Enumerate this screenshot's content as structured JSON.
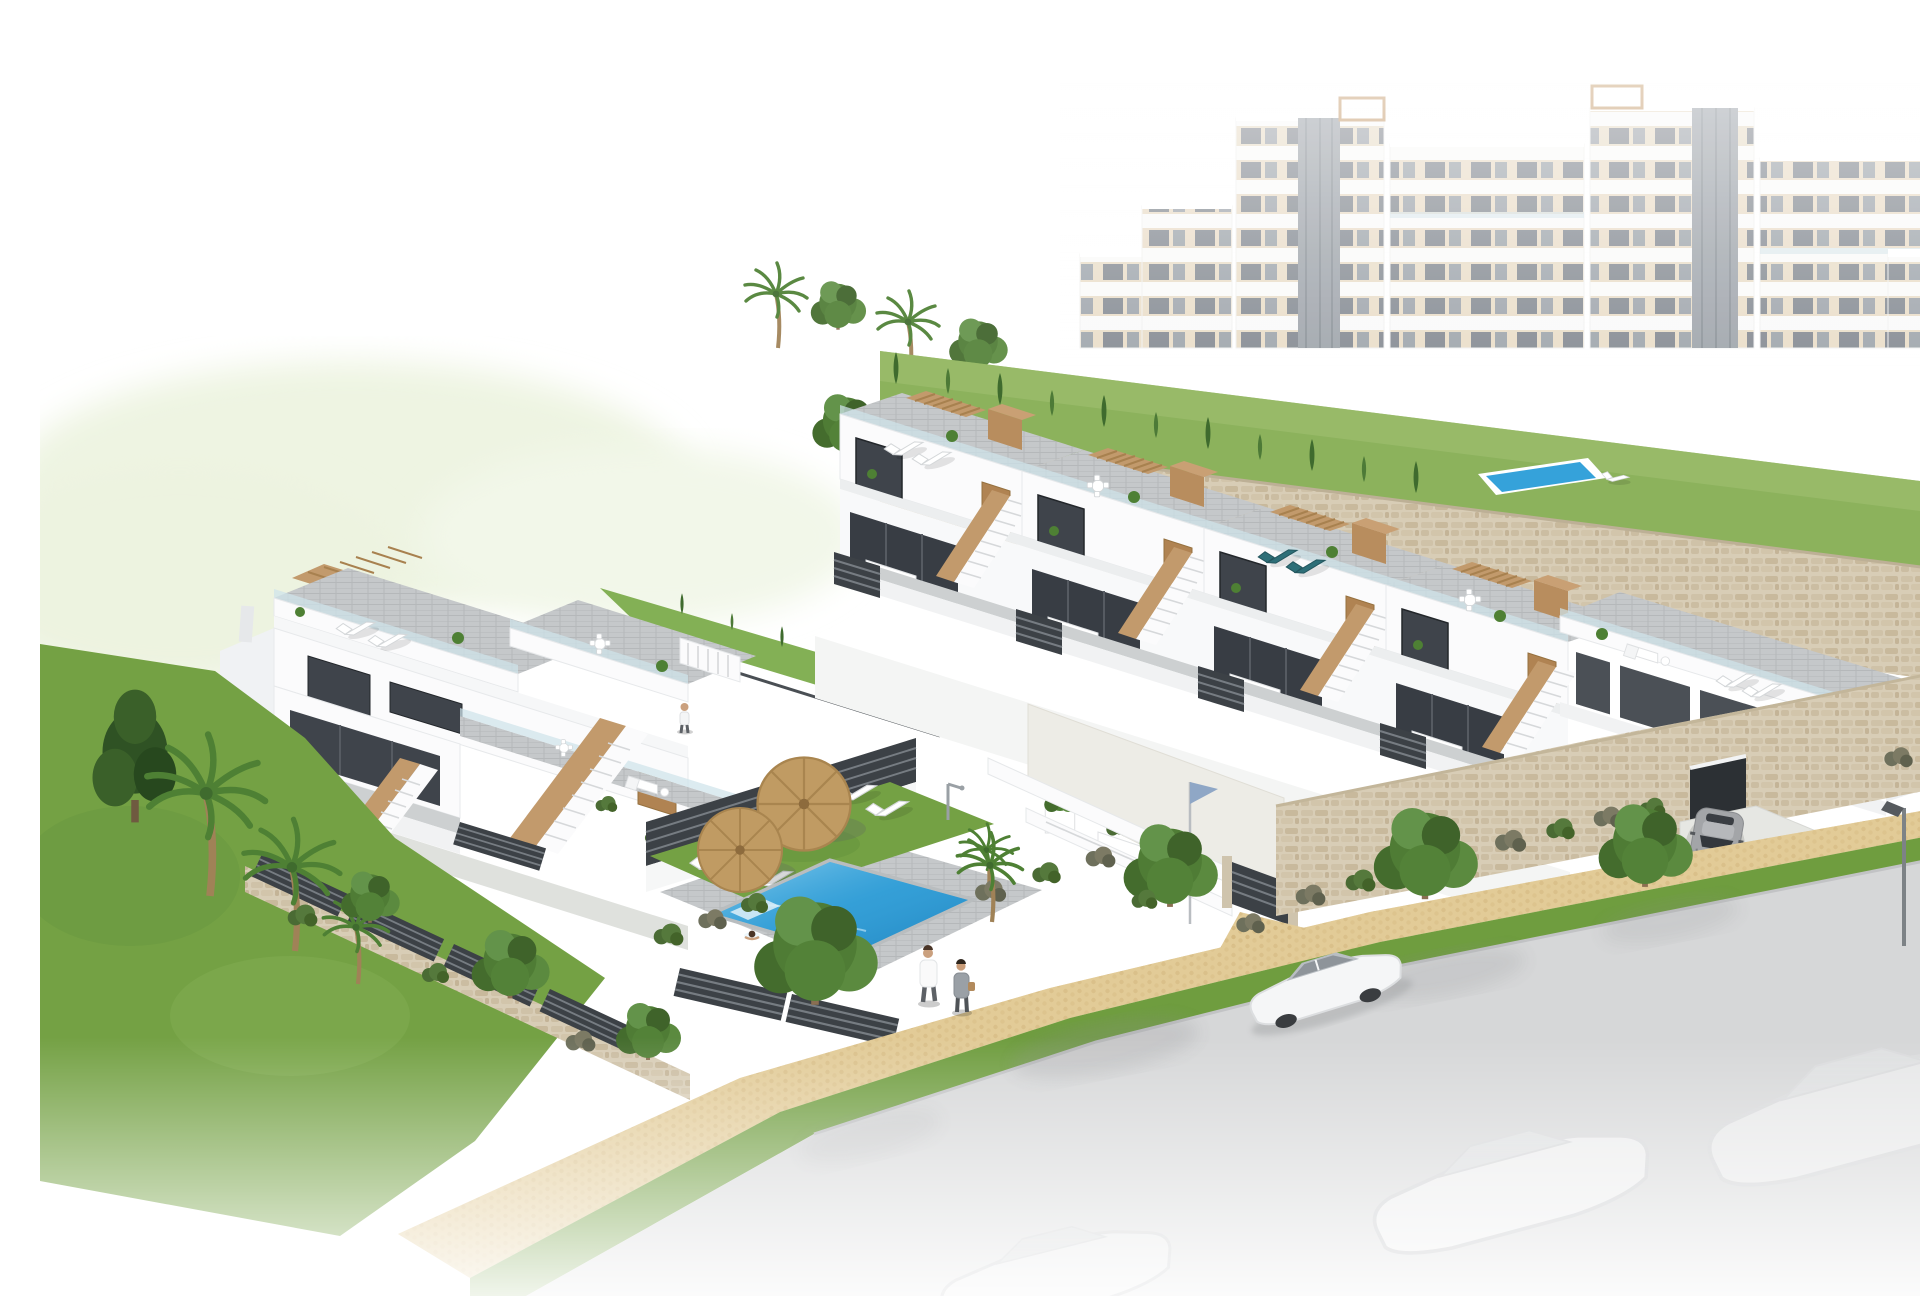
{
  "scene": {
    "title": "Aerial 3D render of a modern white residential complex with communal pool",
    "description": "Photorealistic architectural visualization: hazy white apartment towers with beige panels in the background on a stone-walled slope; two rows of white terraced townhouses with roof terraces, tan wood pergolas, external staircases and dark slatted fences; a communal pool area with two straw parasols, six white sun loungers, a sunbather and a swimmer; landscaped gardens with palms, cypresses and hedges; a beige cobble path with two pedestrians; a grey street fading to white with a white sedan, faint ghost cars, a grey coupe on a garage driveway, a small flag pole and a street lamp.",
    "style": "architectural-cgi",
    "background_color": "#ffffff",
    "palette": {
      "wall_white": "#fbfbfc",
      "wall_shadow": "#e8eaed",
      "wood_accent": "#c29a6c",
      "pergola_slat": "#a8814f",
      "glass_dark": "#3f444b",
      "glass_light": "#cfe3ea",
      "terrace_paver": "#c5c8ca",
      "stone_wall": "#d8cdb6",
      "plaster_wall": "#edece6",
      "grass": "#74a144",
      "hedge_dark": "#4a6b34",
      "tree_green": "#54823a",
      "pool_blue": "#2d9ad4",
      "umbrella_straw": "#c09b63",
      "cobble_path": "#e2cb97",
      "road_asphalt": "#d6d7d8",
      "fence_dark": "#3c4146",
      "flag_blue": "#8fa7c6"
    },
    "inventory": {
      "apartment_towers": 6,
      "townhouse_units_right_row": 4,
      "townhouse_end_house": 1,
      "townhouse_left_block_levels": 3,
      "pools": 2,
      "straw_parasols": 2,
      "pool_sun_loungers": 6,
      "roof_furniture_sets": 6,
      "people": 5,
      "cars_visible": 2,
      "ghost_cars": 3,
      "palm_trees": 6,
      "cypress_trees": 20,
      "big_trees": 7,
      "street_lamps": 1,
      "flag_poles": 1,
      "garage_doors": 2,
      "gates": 1
    },
    "people": [
      {
        "id": "terrace-walker",
        "desc": "person standing on first-floor terrace"
      },
      {
        "id": "sunbather",
        "desc": "woman in pink on a lounger by the pool"
      },
      {
        "id": "swimmer",
        "desc": "swimmer in the communal pool"
      },
      {
        "id": "walker-male",
        "desc": "man in white shirt walking on cobble path"
      },
      {
        "id": "walker-female",
        "desc": "woman in grey walking on cobble path"
      }
    ],
    "vehicles": [
      {
        "id": "white-sedan",
        "desc": "white sedan driving on the street",
        "color": "#f5f6f7"
      },
      {
        "id": "grey-coupe",
        "desc": "grey coupe parked on the garage driveway",
        "color": "#a3a5a8"
      }
    ]
  }
}
